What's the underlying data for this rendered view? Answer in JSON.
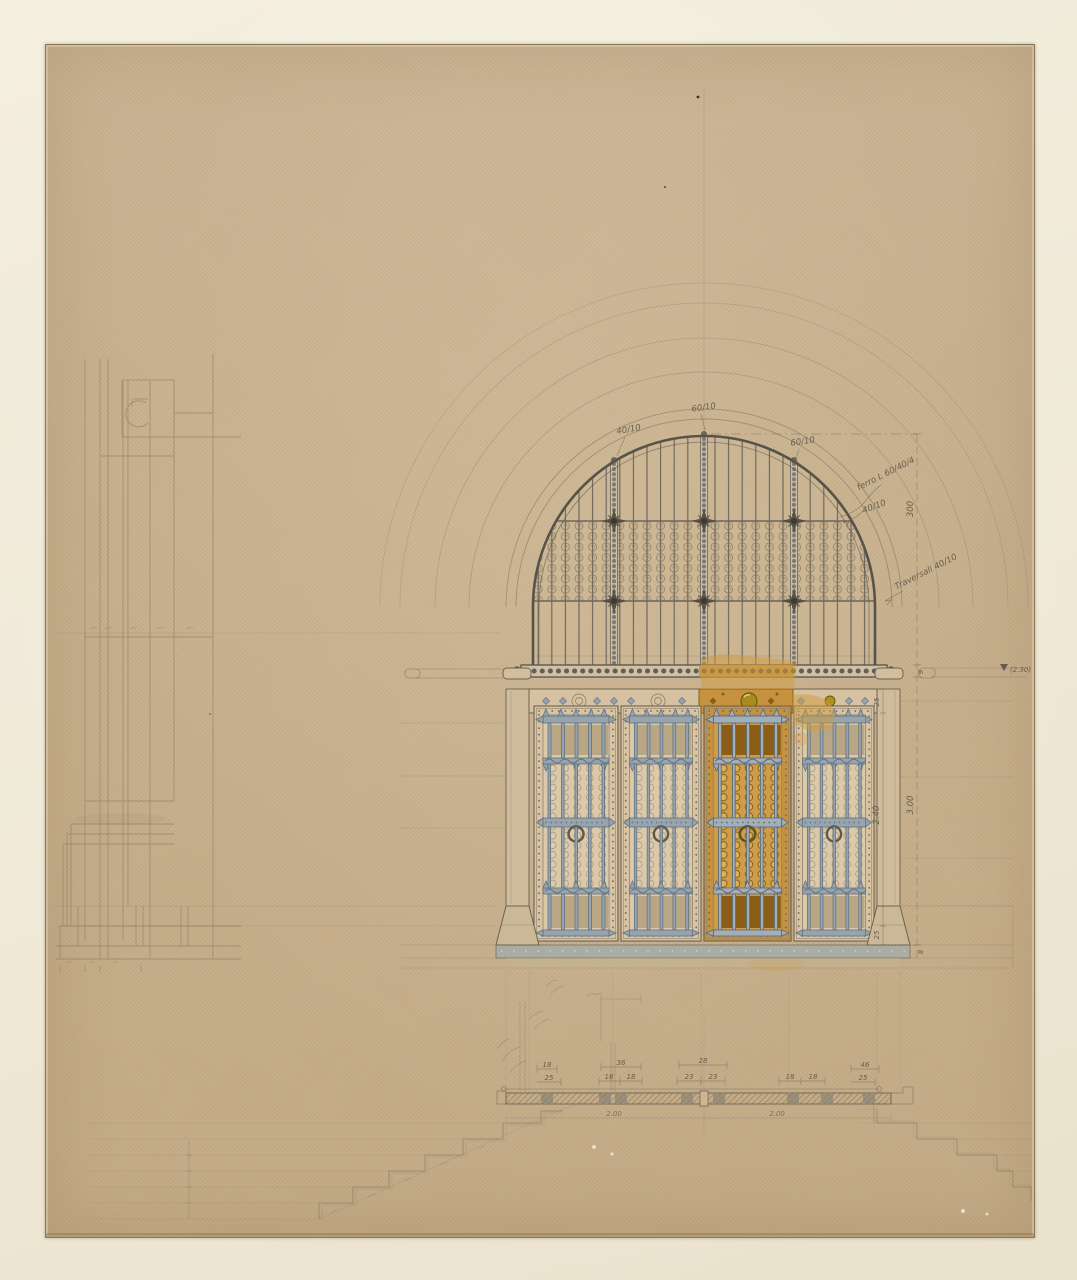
{
  "artwork": {
    "description": "Architectural presentation drawing of an arched portal with wrought-iron lunette grille, four iron-clad door leaves (one picked out in gold), plan of threshold and steps",
    "colors": {
      "mat": "#f0e9d7",
      "paper": "#c9b28f",
      "pencil": "#6d6553",
      "iron_grey": "#97a3ad",
      "iron_dark": "#63727f",
      "gold": "#c79240",
      "gold_dark": "#8a5e16",
      "threshold_grey": "#a7ada6"
    }
  },
  "annotations": {
    "arch_top": "60/10",
    "arch_left": "40/10",
    "arch_right": "60/10",
    "iron_note": "ferro L 60/40/4",
    "bar_note": "40/10",
    "height_total": "300",
    "transom_note": "Traversali 40/10",
    "level_mark": "(2.30)",
    "tick_9": "9",
    "tick_25_top": "25",
    "door_height": "2.40",
    "opening_height": "3.00",
    "tick_25_bottom": "25",
    "tick_8": "8"
  },
  "plan": {
    "w18": "18",
    "w36": "36",
    "w46": "46",
    "w28": "28",
    "s25l": "25",
    "s18a": "18",
    "s18b": "18",
    "s23a": "23",
    "s23b": "23",
    "s18c": "18",
    "s18d": "18",
    "s25r": "25",
    "m200l": "2.00",
    "m200r": "2.00"
  }
}
